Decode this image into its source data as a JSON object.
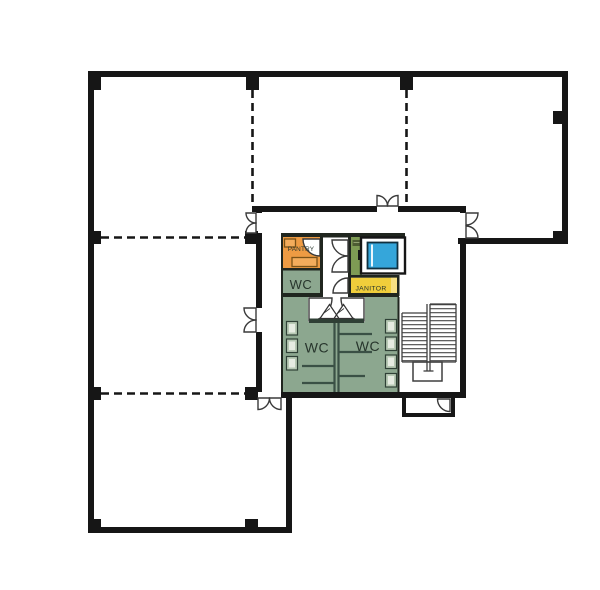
{
  "plan": {
    "rooms": {
      "pantry": {
        "label": "PANTRY",
        "color": "#EE9B43"
      },
      "wc_upper": {
        "label": "WC",
        "color": "#8CA78F"
      },
      "wc_main": {
        "color": "#8CA78F"
      },
      "wc_left": {
        "label": "WC"
      },
      "wc_right": {
        "label": "WC"
      },
      "janitor": {
        "label": "JANITOR",
        "color": "#F0CE3B",
        "light": "#F7E083"
      },
      "shaft": {
        "color": "#7E9B54",
        "panel": "#4D5C33"
      },
      "elevator": {
        "color": "#35A6DA"
      }
    },
    "colors": {
      "wall": "#161616",
      "furniture": "#F3AC5C",
      "fixture": "#B7C9B4",
      "partition": "#3A5045",
      "label": "#27352C"
    }
  }
}
